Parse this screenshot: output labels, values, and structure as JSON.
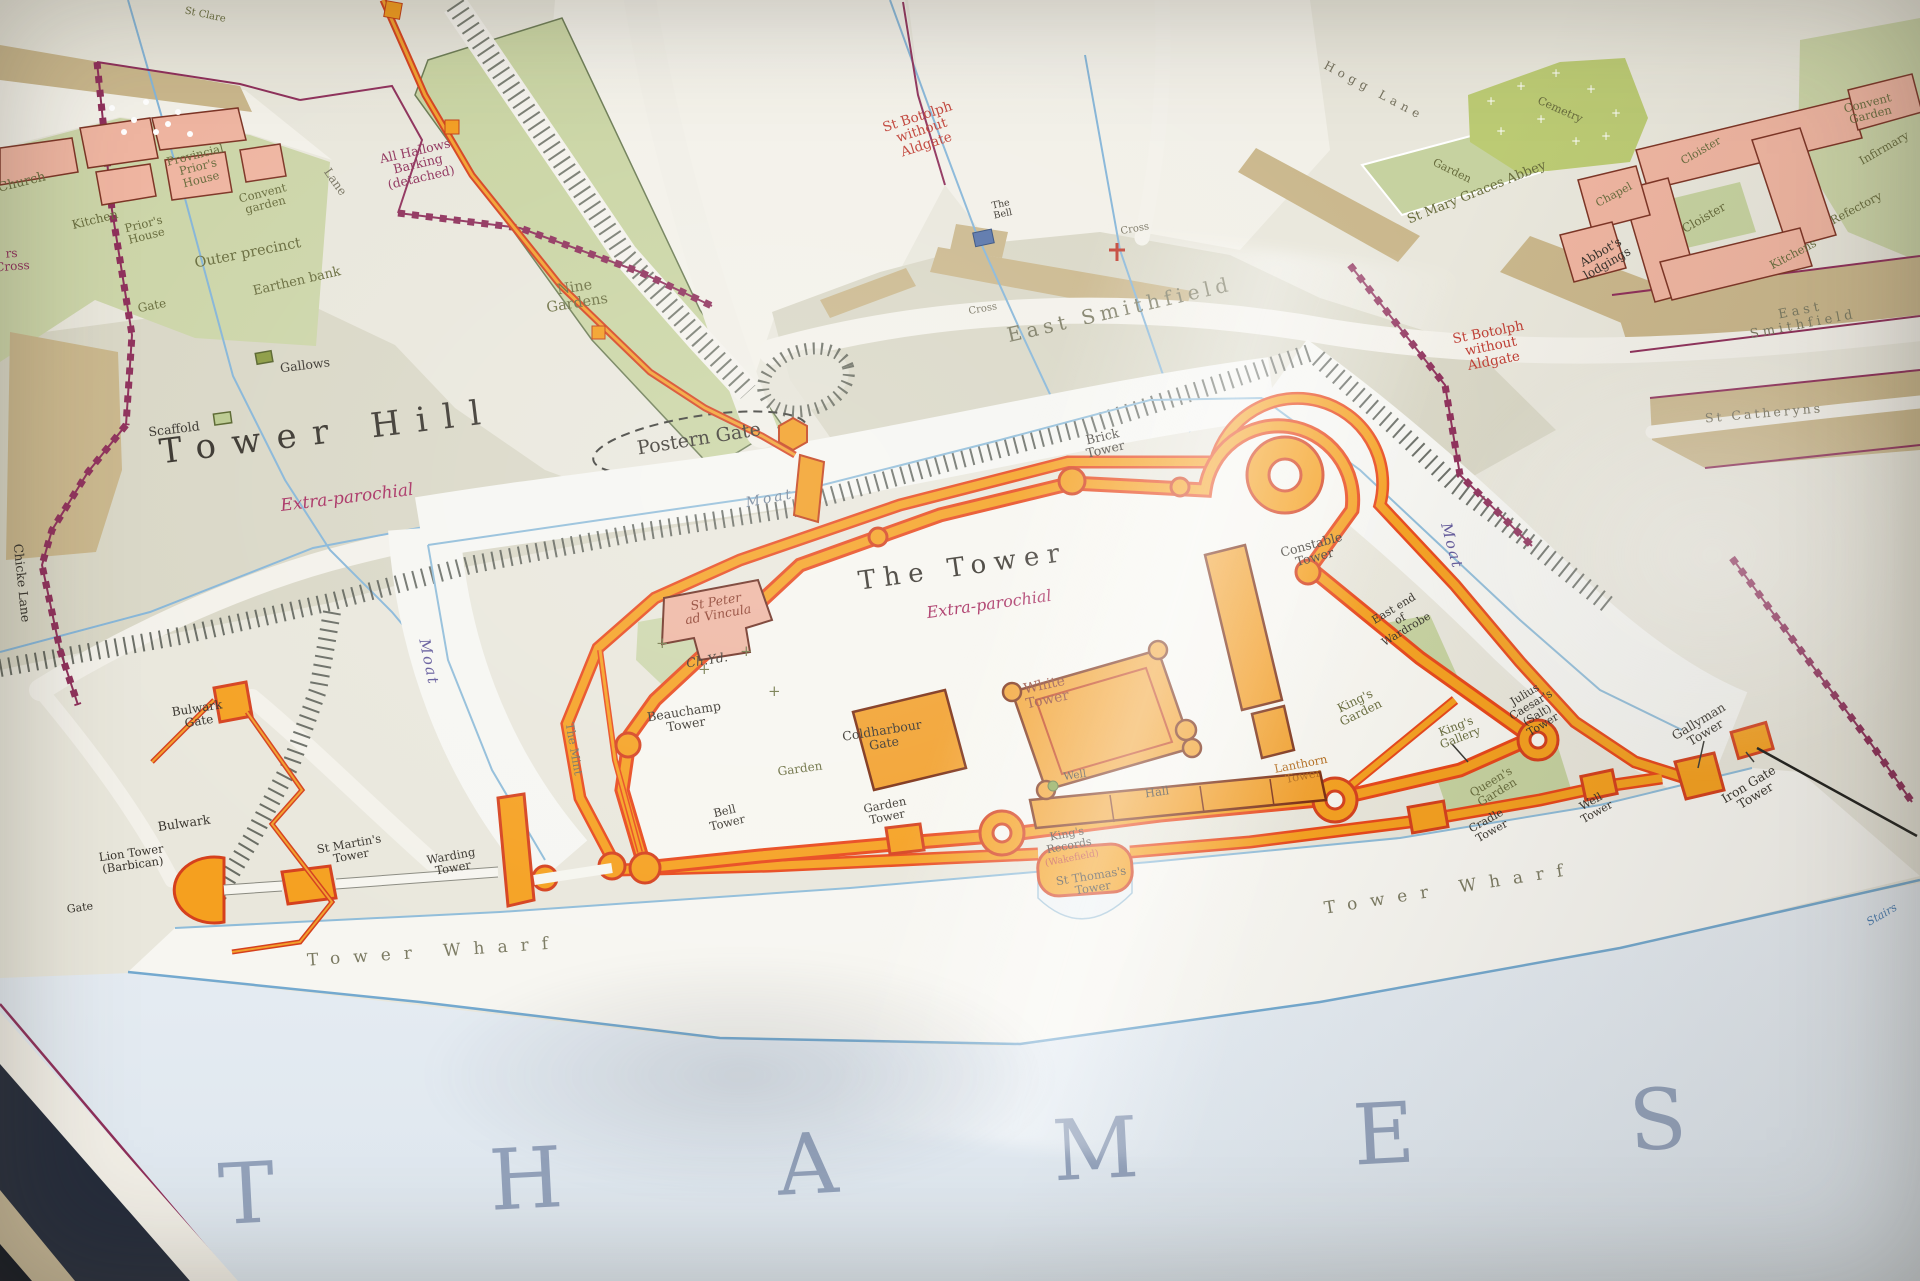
{
  "map_title_area": {
    "main_area_label": "The Tower",
    "main_area_status": "Extra-parochial",
    "hill_label": "Tower Hill",
    "river_label": "THAMES"
  },
  "colors": {
    "ink": "#37332c",
    "olive": "#686c3d",
    "maroon": "#8e2f5a",
    "red": "#c03f35",
    "magenta": "#a62a5e",
    "darkred": "#8a3a28",
    "purple": "#5f5699",
    "blue": "#4a7fb5",
    "gray": "#76725f",
    "grayolive": "#7b7a62",
    "grayblue": "#93a2bb",
    "bluegray": "#6e8096",
    "orangebrown": "#b26a1a",
    "wall_orange": "#f5a01f",
    "wall_red": "#e8471b",
    "boundary_maroon": "#8e2f5a",
    "city_wall_red": "#d5401d",
    "garden_green": "#c6d2a0",
    "cemetery_lime": "#bccb74",
    "building_pink": "#efb5a1",
    "street_tan": "#cab78c",
    "water_blue": "#85b5d8"
  },
  "labels": [
    {
      "id": "church",
      "t": "Church",
      "x": 22,
      "y": 183,
      "r": -14,
      "s": 13,
      "c": "olive"
    },
    {
      "id": "kitchen",
      "t": "Kitchen",
      "x": 95,
      "y": 220,
      "r": -14,
      "s": 12,
      "c": "olive"
    },
    {
      "id": "priors-house",
      "t": "Prior's\nHouse",
      "x": 145,
      "y": 230,
      "r": -14,
      "s": 11.5,
      "c": "olive"
    },
    {
      "id": "provincial-priors-house",
      "t": "Provincial\nPrior's\nHouse",
      "x": 198,
      "y": 167,
      "r": -14,
      "s": 11.5,
      "c": "olive"
    },
    {
      "id": "convent-garden-minories",
      "t": "Convent\ngarden",
      "x": 264,
      "y": 199,
      "r": -14,
      "s": 11.5,
      "c": "olive"
    },
    {
      "id": "outer-precinct",
      "t": "Outer precinct",
      "x": 248,
      "y": 254,
      "r": -11,
      "s": 14.5,
      "c": "olive"
    },
    {
      "id": "earthen-bank",
      "t": "Earthen bank",
      "x": 297,
      "y": 282,
      "r": -13,
      "s": 13,
      "c": "olive"
    },
    {
      "id": "gate-minories",
      "t": "Gate",
      "x": 152,
      "y": 306,
      "r": -11,
      "s": 12,
      "c": "olive"
    },
    {
      "id": "st-clare",
      "t": "St Clare",
      "x": 205,
      "y": 16,
      "r": 12,
      "s": 10,
      "c": "olive"
    },
    {
      "id": "west-edge-partial",
      "t": "rs\nCross",
      "x": 12,
      "y": 260,
      "r": -4,
      "s": 12,
      "c": "maroon"
    },
    {
      "id": "all-hallows",
      "t": "All Hallows\nBarking\n(detached)",
      "x": 418,
      "y": 164,
      "r": -13,
      "s": 12.5,
      "c": "maroon"
    },
    {
      "id": "lane",
      "t": "Lane",
      "x": 335,
      "y": 182,
      "r": 55,
      "s": 12,
      "c": "gray"
    },
    {
      "id": "nine-gardens",
      "t": "Nine\nGardens",
      "x": 576,
      "y": 296,
      "r": -9,
      "s": 14.5,
      "c": "olive"
    },
    {
      "id": "gallows",
      "t": "Gallows",
      "x": 305,
      "y": 365,
      "r": -7,
      "s": 12.5,
      "c": "ink"
    },
    {
      "id": "scaffold",
      "t": "Scaffold",
      "x": 174,
      "y": 429,
      "r": -7,
      "s": 12.5,
      "c": "ink"
    },
    {
      "id": "tower-hill",
      "t": "Tower Hill",
      "x": 328,
      "y": 432,
      "r": -7,
      "s": 34,
      "c": "ink",
      "sp": 16
    },
    {
      "id": "extra-parochial-hill",
      "t": "Extra-parochial",
      "x": 347,
      "y": 498,
      "r": -7,
      "s": 17,
      "c": "magenta",
      "i": 1
    },
    {
      "id": "chicke-lane",
      "t": "Chicke Lane",
      "x": 22,
      "y": 583,
      "r": 84,
      "s": 12.5,
      "c": "ink"
    },
    {
      "id": "postern-gate",
      "t": "Postern Gate",
      "x": 699,
      "y": 439,
      "r": -9,
      "s": 19,
      "c": "ink"
    },
    {
      "id": "moat-north",
      "t": "Moat",
      "x": 770,
      "y": 499,
      "r": -11,
      "s": 14,
      "c": "bluegray",
      "i": 1,
      "sp": 3
    },
    {
      "id": "moat-west",
      "t": "Moat",
      "x": 429,
      "y": 662,
      "r": 78,
      "s": 15,
      "c": "purple",
      "i": 1,
      "sp": 2
    },
    {
      "id": "moat-east",
      "t": "Moat",
      "x": 1452,
      "y": 546,
      "r": 75,
      "s": 15,
      "c": "purple",
      "i": 1,
      "sp": 2
    },
    {
      "id": "east-smithfield",
      "t": "East Smithfield",
      "x": 1120,
      "y": 310,
      "r": -13,
      "s": 20,
      "c": "grayolive",
      "sp": 5
    },
    {
      "id": "st-botolph-1",
      "t": "St Botolph\nwithout\nAldgate",
      "x": 922,
      "y": 131,
      "r": -18,
      "s": 13.5,
      "c": "red"
    },
    {
      "id": "the-bell",
      "t": "The\nBell",
      "x": 1002,
      "y": 210,
      "r": -12,
      "s": 9.5,
      "c": "ink"
    },
    {
      "id": "cross-1",
      "t": "Cross",
      "x": 983,
      "y": 310,
      "r": -10,
      "s": 10,
      "c": "gray"
    },
    {
      "id": "cross-2",
      "t": "Cross",
      "x": 1135,
      "y": 230,
      "r": -10,
      "s": 10,
      "c": "gray"
    },
    {
      "id": "hogg-lane",
      "t": "Hogg Lane",
      "x": 1374,
      "y": 91,
      "r": 28,
      "s": 12,
      "c": "gray",
      "sp": 5
    },
    {
      "id": "cemetery",
      "t": "Cemetry",
      "x": 1560,
      "y": 110,
      "r": 24,
      "s": 11,
      "c": "olive"
    },
    {
      "id": "garden-abbey",
      "t": "Garden",
      "x": 1452,
      "y": 171,
      "r": 26,
      "s": 11,
      "c": "olive"
    },
    {
      "id": "st-mary-graces",
      "t": "St Mary Graces Abbey",
      "x": 1477,
      "y": 193,
      "r": -22,
      "s": 13,
      "c": "olive"
    },
    {
      "id": "chapel",
      "t": "Chapel",
      "x": 1614,
      "y": 195,
      "r": -28,
      "s": 11,
      "c": "olive"
    },
    {
      "id": "cloister-1",
      "t": "Cloister",
      "x": 1701,
      "y": 151,
      "r": -30,
      "s": 11,
      "c": "olive"
    },
    {
      "id": "cloister-2",
      "t": "Cloister",
      "x": 1704,
      "y": 218,
      "r": -30,
      "s": 12,
      "c": "olive"
    },
    {
      "id": "abbots-lodgings",
      "t": "Abbot's\nlodgings",
      "x": 1604,
      "y": 258,
      "r": -30,
      "s": 12,
      "c": "ink"
    },
    {
      "id": "refectory",
      "t": "Refectory",
      "x": 1856,
      "y": 208,
      "r": -28,
      "s": 11.5,
      "c": "olive"
    },
    {
      "id": "kitchens-abbey",
      "t": "Kitchens",
      "x": 1793,
      "y": 254,
      "r": -28,
      "s": 11.5,
      "c": "olive"
    },
    {
      "id": "convent-garden-abbey",
      "t": "Convent\nGarden",
      "x": 1869,
      "y": 109,
      "r": -14,
      "s": 11.5,
      "c": "olive"
    },
    {
      "id": "infirmary",
      "t": "Infirmary",
      "x": 1884,
      "y": 148,
      "r": -30,
      "s": 11.5,
      "c": "olive"
    },
    {
      "id": "east-smithfield-2",
      "t": "East Smithfield",
      "x": 1802,
      "y": 318,
      "r": -11,
      "s": 13,
      "c": "grayolive",
      "sp": 4
    },
    {
      "id": "st-catheryns",
      "t": "St Catheryns",
      "x": 1764,
      "y": 413,
      "r": -5,
      "s": 12.5,
      "c": "gray",
      "sp": 3
    },
    {
      "id": "st-botolph-2",
      "t": "St Botolph\nwithout\nAldgate",
      "x": 1491,
      "y": 347,
      "r": -11,
      "s": 13.5,
      "c": "red"
    },
    {
      "id": "brick-tower",
      "t": "Brick\nTower",
      "x": 1104,
      "y": 443,
      "r": -13,
      "s": 12.5,
      "c": "ink"
    },
    {
      "id": "constable-tower",
      "t": "Constable\nTower",
      "x": 1313,
      "y": 551,
      "r": -15,
      "s": 12.5,
      "c": "ink"
    },
    {
      "id": "the-tower",
      "t": "The Tower",
      "x": 963,
      "y": 568,
      "r": -8,
      "s": 26,
      "c": "ink",
      "sp": 8
    },
    {
      "id": "extra-parochial-tower",
      "t": "Extra-parochial",
      "x": 989,
      "y": 604,
      "r": -8,
      "s": 16,
      "c": "magenta",
      "i": 1
    },
    {
      "id": "st-peter",
      "t": "St Peter\nad Vincula",
      "x": 717,
      "y": 608,
      "r": -10,
      "s": 12.5,
      "c": "darkred",
      "i": 1
    },
    {
      "id": "ch-yd",
      "t": "Ch.Yd.",
      "x": 707,
      "y": 660,
      "r": -9,
      "s": 12.5,
      "c": "ink",
      "i": 1
    },
    {
      "id": "white-tower",
      "t": "White\nTower",
      "x": 1046,
      "y": 693,
      "r": -12,
      "s": 14,
      "c": "darkred"
    },
    {
      "id": "beauchamp-tower",
      "t": "Beauchamp\nTower",
      "x": 685,
      "y": 718,
      "r": -9,
      "s": 12.5,
      "c": "ink"
    },
    {
      "id": "the-mint",
      "t": "The Mint",
      "x": 574,
      "y": 749,
      "r": 80,
      "s": 11.5,
      "c": "gray"
    },
    {
      "id": "coldharbour-gate",
      "t": "Coldharbour\nGate",
      "x": 883,
      "y": 737,
      "r": -9,
      "s": 12.5,
      "c": "ink"
    },
    {
      "id": "well",
      "t": "Well",
      "x": 1075,
      "y": 776,
      "r": -9,
      "s": 10.5,
      "c": "ink"
    },
    {
      "id": "hall",
      "t": "Hall",
      "x": 1157,
      "y": 792,
      "r": -8,
      "s": 11.5,
      "c": "ink"
    },
    {
      "id": "garden-sw",
      "t": "Garden",
      "x": 800,
      "y": 769,
      "r": -8,
      "s": 12,
      "c": "olive"
    },
    {
      "id": "bell-tower",
      "t": "Bell\nTower",
      "x": 726,
      "y": 817,
      "r": -13,
      "s": 11.5,
      "c": "ink"
    },
    {
      "id": "garden-tower",
      "t": "Garden\nTower",
      "x": 886,
      "y": 811,
      "r": -11,
      "s": 11.5,
      "c": "ink"
    },
    {
      "id": "kings-records",
      "t": "King's\nRecords",
      "x": 1068,
      "y": 840,
      "r": -11,
      "s": 11,
      "c": "ink"
    },
    {
      "id": "wakefield",
      "t": "(Wakefield)",
      "x": 1072,
      "y": 859,
      "r": -11,
      "s": 9.5,
      "c": "red"
    },
    {
      "id": "st-thomass-tower",
      "t": "St Thomas's\nTower",
      "x": 1092,
      "y": 882,
      "r": -9,
      "s": 11.5,
      "c": "ink"
    },
    {
      "id": "lanthorn-tower",
      "t": "Lanthorn\nTower",
      "x": 1302,
      "y": 770,
      "r": -11,
      "s": 11.5,
      "c": "orangebrown"
    },
    {
      "id": "kings-garden",
      "t": "King's\nGarden",
      "x": 1358,
      "y": 707,
      "r": -26,
      "s": 12,
      "c": "olive"
    },
    {
      "id": "kings-gallery",
      "t": "King's\nGallery",
      "x": 1458,
      "y": 732,
      "r": -21,
      "s": 11.5,
      "c": "olive"
    },
    {
      "id": "julius-caesars-tower",
      "t": "Julius\nCaesar's\n(Salt)\nTower",
      "x": 1534,
      "y": 710,
      "r": -31,
      "s": 11,
      "c": "ink"
    },
    {
      "id": "queens-garden",
      "t": "Queen's\nGarden",
      "x": 1494,
      "y": 787,
      "r": -31,
      "s": 11.5,
      "c": "olive"
    },
    {
      "id": "cradle-tower",
      "t": "Cradle\nTower",
      "x": 1489,
      "y": 826,
      "r": -29,
      "s": 11,
      "c": "ink"
    },
    {
      "id": "well-tower",
      "t": "Well\nTower",
      "x": 1594,
      "y": 807,
      "r": -29,
      "s": 11,
      "c": "ink"
    },
    {
      "id": "gallyman-tower",
      "t": "Gallyman\nTower",
      "x": 1702,
      "y": 727,
      "r": -31,
      "s": 12.5,
      "c": "ink"
    },
    {
      "id": "iron-gate-tower",
      "t": "Iron Gate\nTower",
      "x": 1752,
      "y": 790,
      "r": -31,
      "s": 12.5,
      "c": "ink"
    },
    {
      "id": "east-end-wardrobe",
      "t": "East end\nof\nWardrobe",
      "x": 1400,
      "y": 619,
      "r": -31,
      "s": 11,
      "c": "ink"
    },
    {
      "id": "lion-tower",
      "t": "Lion Tower\n(Barbican)",
      "x": 132,
      "y": 859,
      "r": -8,
      "s": 11.5,
      "c": "ink"
    },
    {
      "id": "gate-lion",
      "t": "Gate",
      "x": 80,
      "y": 908,
      "r": -8,
      "s": 11,
      "c": "ink"
    },
    {
      "id": "st-martins-tower",
      "t": "St Martin's\nTower",
      "x": 350,
      "y": 850,
      "r": -10,
      "s": 11.5,
      "c": "ink"
    },
    {
      "id": "warding-tower",
      "t": "Warding\nTower",
      "x": 452,
      "y": 862,
      "r": -10,
      "s": 11.5,
      "c": "ink"
    },
    {
      "id": "bulwark-gate",
      "t": "Bulwark\nGate",
      "x": 198,
      "y": 715,
      "r": -9,
      "s": 12,
      "c": "ink"
    },
    {
      "id": "bulwark",
      "t": "Bulwark",
      "x": 184,
      "y": 823,
      "r": -8,
      "s": 12.5,
      "c": "ink"
    },
    {
      "id": "tower-wharf-1",
      "t": "Tower Wharf",
      "x": 434,
      "y": 952,
      "r": -4,
      "s": 17,
      "c": "grayolive",
      "sp": 13
    },
    {
      "id": "tower-wharf-2",
      "t": "Tower Wharf",
      "x": 1450,
      "y": 889,
      "r": -9,
      "s": 17,
      "c": "grayolive",
      "sp": 13
    },
    {
      "id": "stairs",
      "t": "Stairs",
      "x": 1882,
      "y": 915,
      "r": -30,
      "s": 11,
      "c": "blue",
      "i": 1
    },
    {
      "id": "thames",
      "t": "THAMES",
      "x": 1060,
      "y": 1152,
      "r": -3,
      "s": 84,
      "c": "grayblue",
      "sp": 215
    }
  ]
}
